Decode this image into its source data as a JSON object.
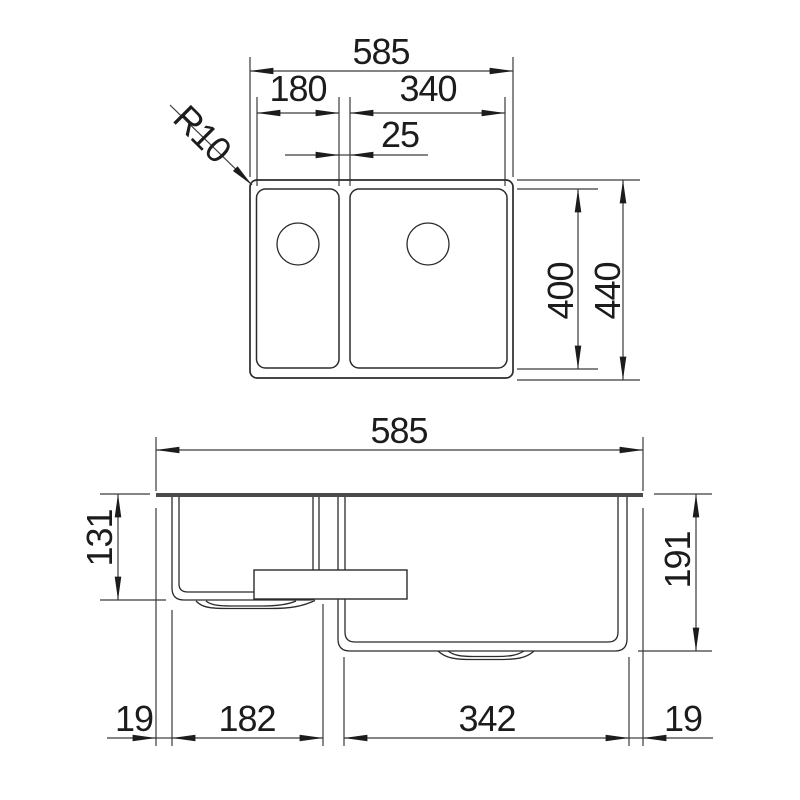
{
  "drawing": {
    "title": "Double-bowl sink installation dimension drawing",
    "units": "mm",
    "colors": {
      "line": "#2b2b2b",
      "dim_line": "#3a3a3a",
      "rim": "#4a4a4a",
      "background": "#ffffff",
      "text": "#1c1c1c"
    },
    "top_view": {
      "overall_width": "585",
      "small_bowl_width": "180",
      "large_bowl_width": "340",
      "bowl_gap": "25",
      "corner_radius": "R10",
      "bowl_length": "400",
      "overall_length": "440"
    },
    "side_view": {
      "overall_width": "585",
      "small_bowl_depth": "131",
      "large_bowl_depth": "191",
      "left_rim_offset": "19",
      "small_bowl_base": "182",
      "large_bowl_base": "342",
      "right_rim_offset": "19"
    }
  }
}
